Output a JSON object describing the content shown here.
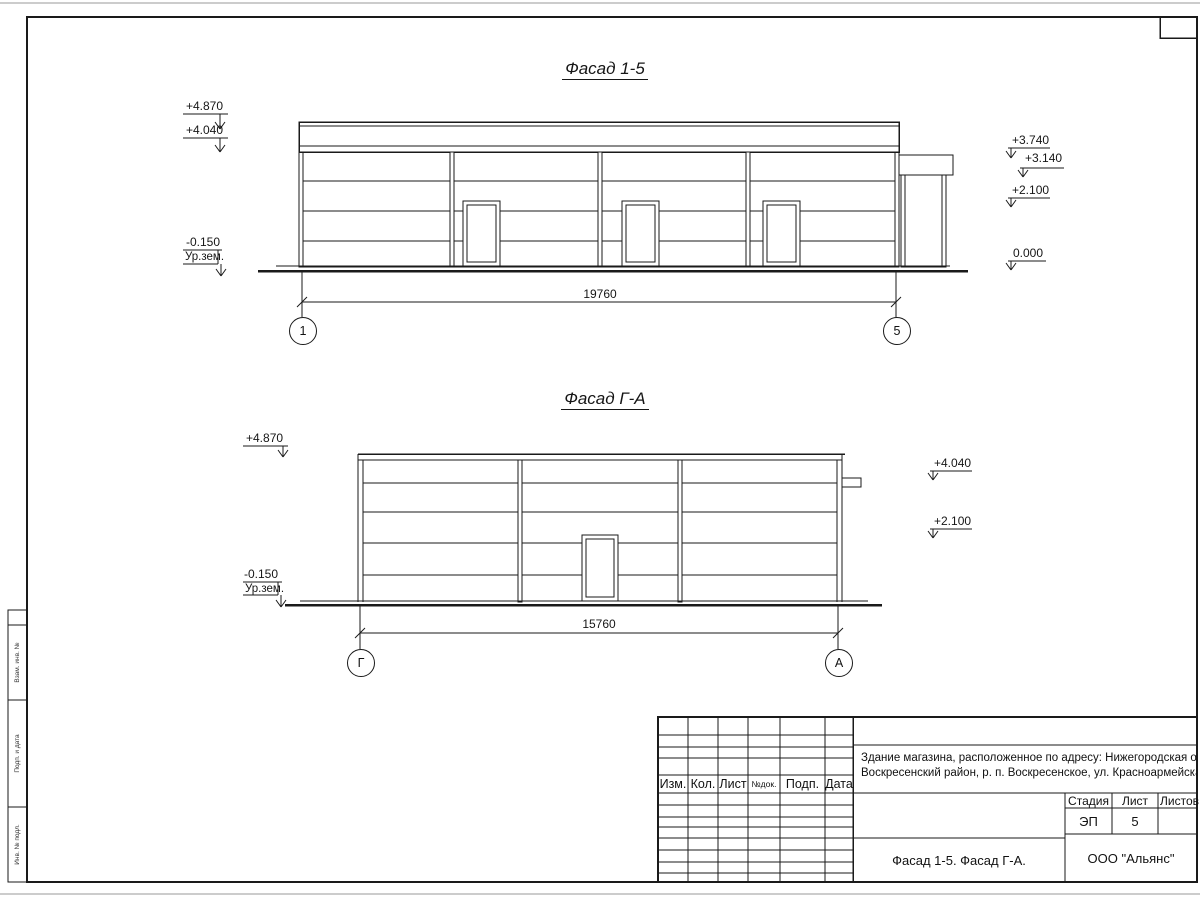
{
  "sheet": {
    "facade_1_5": {
      "title": "Фасад 1-5",
      "marks": {
        "m4870": "+4.870",
        "m4040": "+4.040",
        "m0150": "-0.150",
        "ground_label": "Ур.зем.",
        "m3740": "+3.740",
        "m3140": "+3.140",
        "m2100": "+2.100",
        "m0000": "0.000"
      },
      "dimension": "19760",
      "axis_left": "1",
      "axis_right": "5"
    },
    "facade_g_a": {
      "title": "Фасад Г-А",
      "marks": {
        "m4870": "+4.870",
        "m0150": "-0.150",
        "ground_label": "Ур.зем.",
        "m4040": "+4.040",
        "m2100": "+2.100"
      },
      "dimension": "15760",
      "axis_left": "Г",
      "axis_right": "А"
    },
    "title_block": {
      "header_cols": [
        "Изм.",
        "Кол.",
        "Лист",
        "№док.",
        "Подп.",
        "Дата"
      ],
      "project_line1": "Здание магазина, расположенное по адресу: Нижегородская область,",
      "project_line2": "Воскресенский район, р. п. Воскресенское, ул. Красноармейская, д. 1",
      "stage_label": "Стадия",
      "sheet_label": "Лист",
      "sheets_label": "Листов",
      "stage_value": "ЭП",
      "sheet_value": "5",
      "doc_title": "Фасад 1-5. Фасад Г-А.",
      "company": "ООО \"Альянс\""
    },
    "side_stamp": {
      "labels": [
        "Взам. инв. №",
        "Подп. и дата",
        "Инв. № подл."
      ]
    }
  }
}
